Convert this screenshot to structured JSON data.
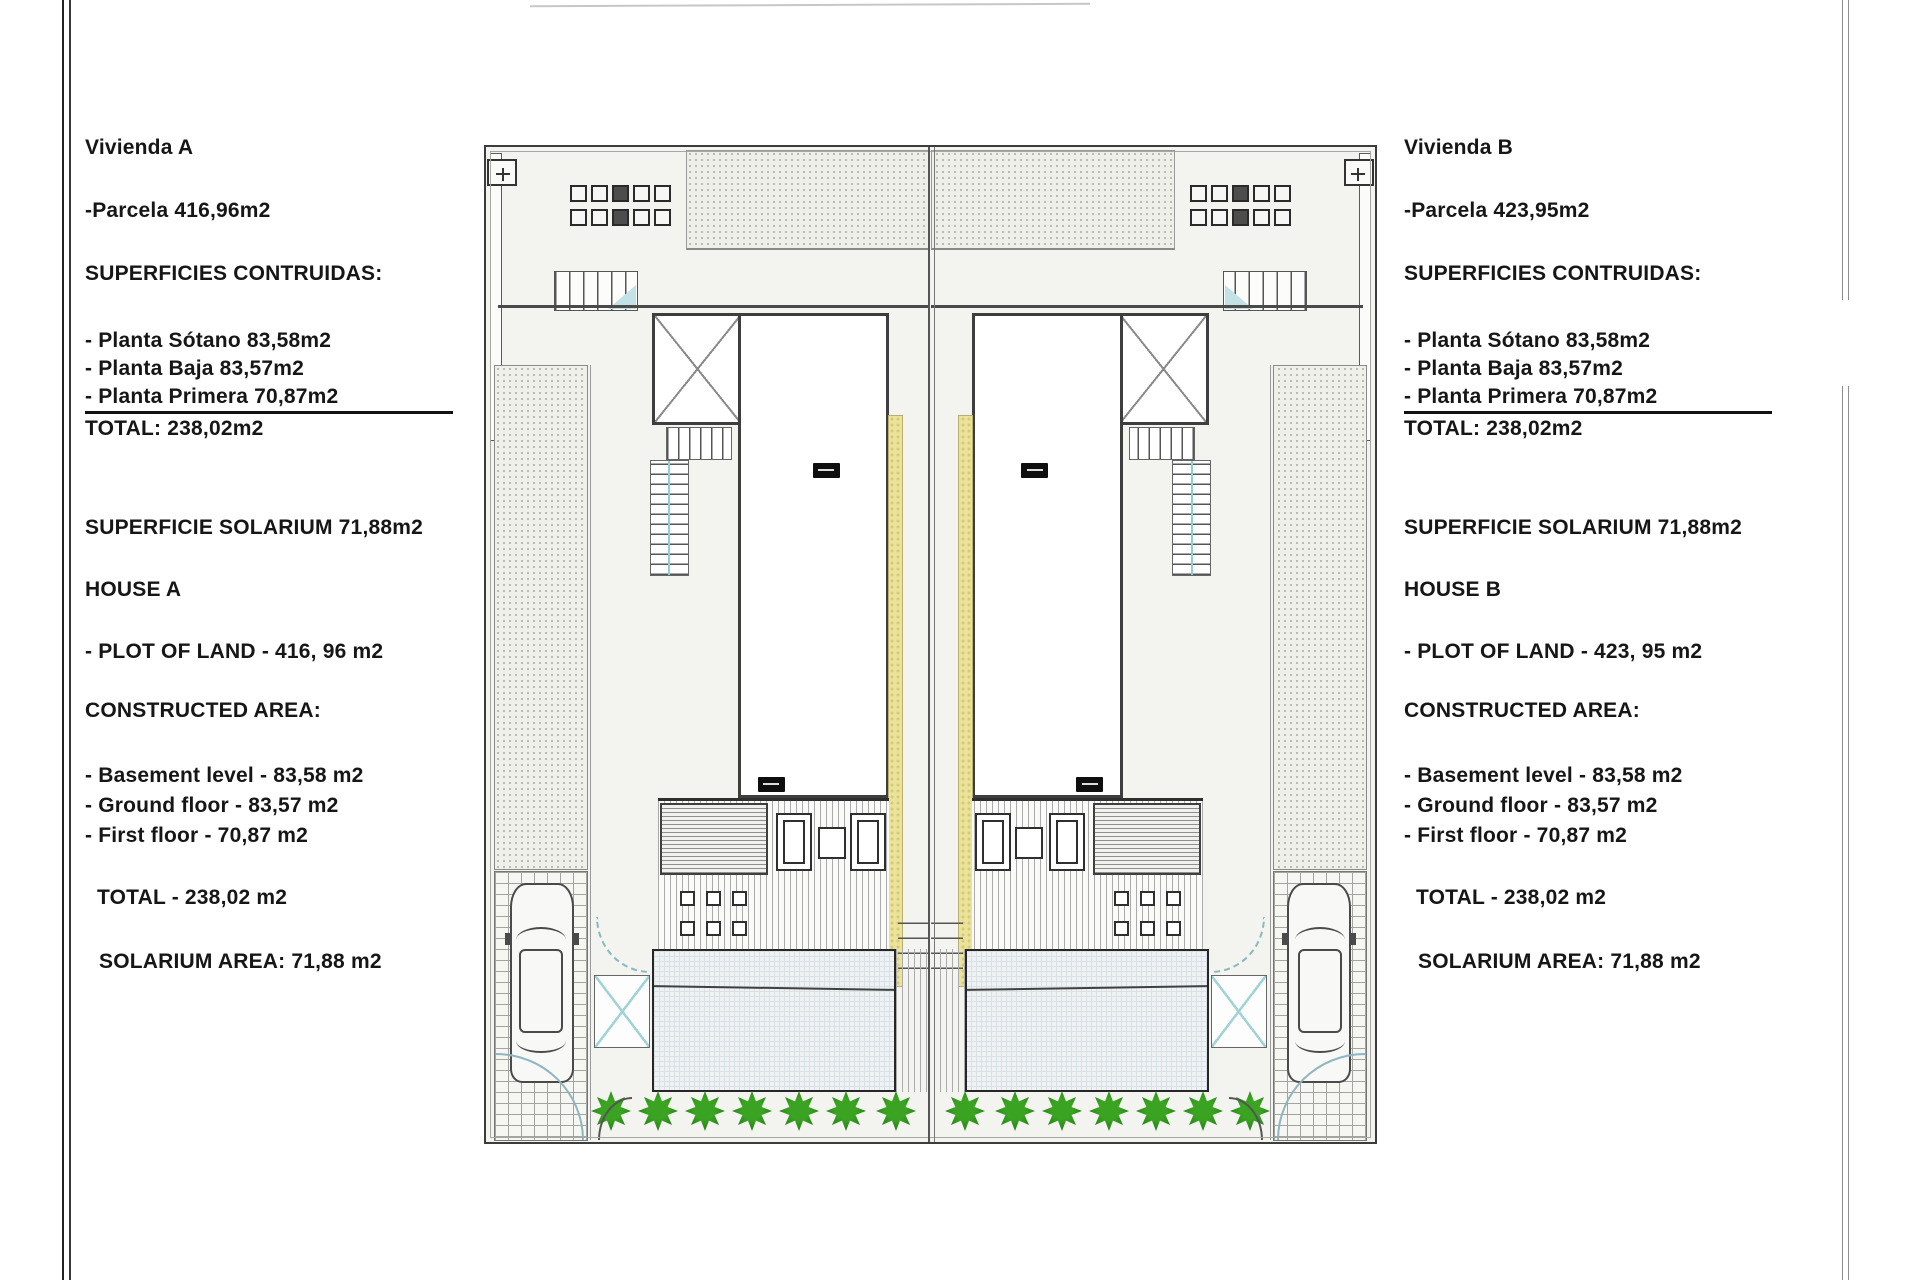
{
  "house_a": {
    "title": "Vivienda A",
    "parcela": "-Parcela 416,96m2",
    "superficies_heading": "SUPERFICIES CONTRUIDAS:",
    "planta_sotano": "- Planta Sótano 83,58m2",
    "planta_baja": "- Planta Baja 83,57m2",
    "planta_primera": "- Planta Primera 70,87m2",
    "total": "TOTAL: 238,02m2",
    "solarium": "SUPERFICIE SOLARIUM 71,88m2",
    "house_heading": "HOUSE A",
    "plot_of_land": "- PLOT OF LAND - 416, 96 m2",
    "constructed_heading": "CONSTRUCTED AREA:",
    "basement": "- Basement level - 83,58 m2",
    "ground_floor": "- Ground floor - 83,57 m2",
    "first_floor": "- First floor - 70,87 m2",
    "total_en": "TOTAL - 238,02 m2",
    "solarium_en": "SOLARIUM AREA: 71,88 m2"
  },
  "house_b": {
    "title": "Vivienda B",
    "parcela": "-Parcela 423,95m2",
    "superficies_heading": "SUPERFICIES CONTRUIDAS:",
    "planta_sotano": "- Planta Sótano 83,58m2",
    "planta_baja": "- Planta Baja 83,57m2",
    "planta_primera": "- Planta Primera 70,87m2",
    "total": "TOTAL: 238,02m2",
    "solarium": "SUPERFICIE SOLARIUM 71,88m2",
    "house_heading": "HOUSE B",
    "plot_of_land": "- PLOT OF LAND - 423, 95 m2",
    "constructed_heading": "CONSTRUCTED AREA:",
    "basement": "- Basement level - 83,58 m2",
    "ground_floor": "- Ground floor - 83,57 m2",
    "first_floor": "- First floor - 70,87 m2",
    "total_en": "TOTAL - 238,02 m2",
    "solarium_en": "SOLARIUM AREA: 71,88 m2"
  },
  "colors": {
    "drawing_line": "#3e3e3e",
    "party_strip_yellow": "#ebe39b",
    "hedge_green": "#27831a",
    "pool_water": "#eef2f4",
    "glass_cyan": "#9fd3d8"
  }
}
